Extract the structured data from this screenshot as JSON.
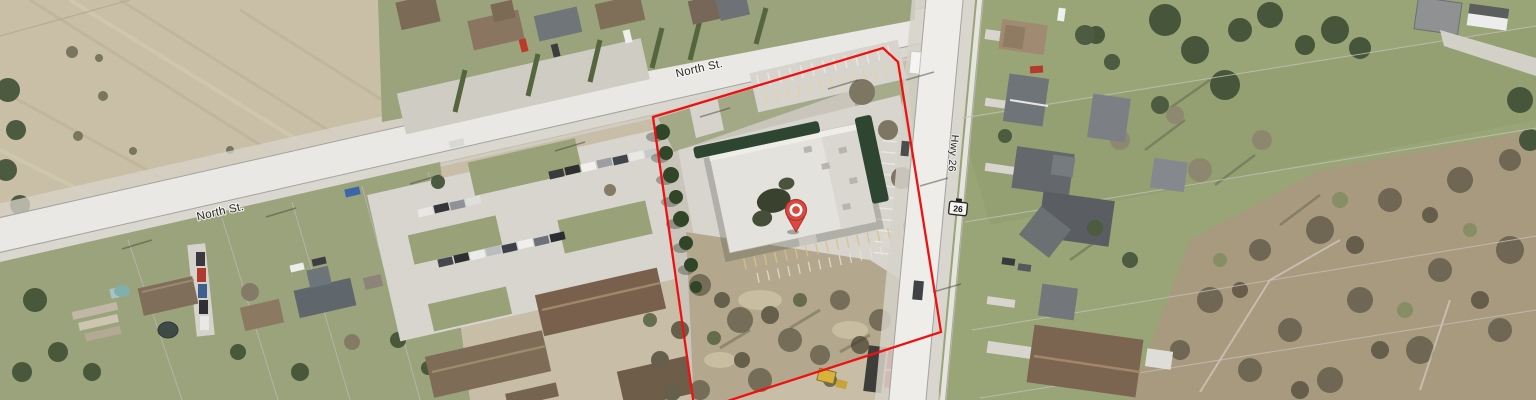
{
  "map": {
    "road_labels": {
      "north_st_upper": "North St.",
      "north_st_lower": "North St.",
      "highway": "Hwy 26"
    },
    "highway_shield": {
      "number": "26"
    },
    "parcel_outline": {
      "color": "#ee1111",
      "points": "653,117 883,48 898,62 941,332 712,406 694,406"
    },
    "marker": {
      "color": "#d9493f"
    },
    "palette": {
      "field": "#c8bea7",
      "road": "#e9e8e4",
      "grass": "#9aa37c",
      "brush": "#b3a88d",
      "dark_tree": "#45523a",
      "building_roof": "#e4e2dc",
      "building_hedge": "#2d4531",
      "townhouse_roof": "#7e6c56",
      "parking": "#d7d5ce"
    }
  }
}
